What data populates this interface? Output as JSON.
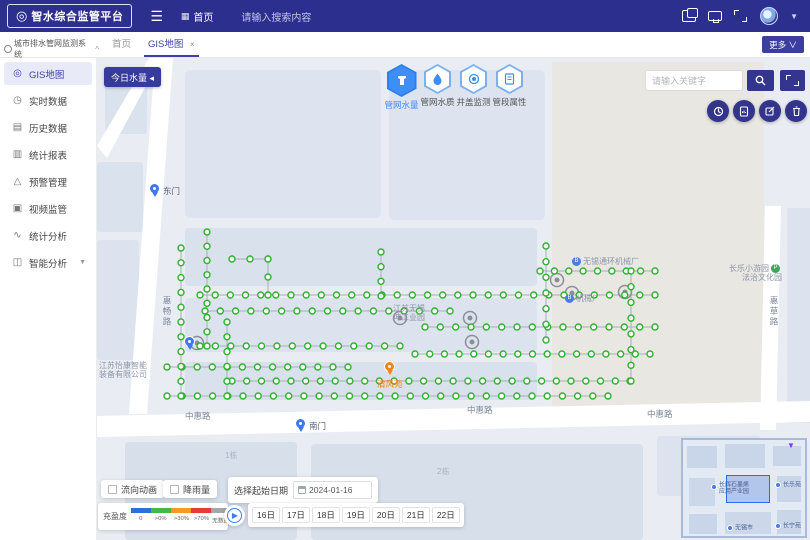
{
  "header": {
    "logo_text": "智水综合监管平台",
    "nav_home": "首页",
    "search_placeholder": "请输入搜索内容"
  },
  "tabbar": {
    "system_title": "城市排水管网监测系统",
    "tabs": [
      {
        "label": "首页"
      },
      {
        "label": "GIS地图",
        "close": "×"
      }
    ],
    "more_label": "更多 ∨"
  },
  "sidebar": {
    "items": [
      {
        "label": "GIS地图",
        "active": true
      },
      {
        "label": "实时数据"
      },
      {
        "label": "历史数据"
      },
      {
        "label": "统计报表"
      },
      {
        "label": "预警管理"
      },
      {
        "label": "视频监管"
      },
      {
        "label": "统计分析"
      },
      {
        "label": "智能分析",
        "expandable": true
      }
    ]
  },
  "map": {
    "today_button": "今日水量 ◂",
    "layer_buttons": [
      {
        "label": "管网水量",
        "active": true
      },
      {
        "label": "管网水质"
      },
      {
        "label": "井盖监测"
      },
      {
        "label": "管段属性"
      }
    ],
    "search_placeholder": "请输入关键字",
    "streets": {
      "left_road": "惠畅路",
      "bottom_road_1": "中惠路",
      "bottom_road_2": "中惠路",
      "bottom_road_3": "中惠路",
      "right_road": "惠草路",
      "bldg_1": "1栋",
      "bldg_2": "2栋"
    },
    "pois": {
      "gate_east": "东门",
      "gate_south": "南门",
      "spring": "清风苑",
      "factory_1": "无锡通环机械厂",
      "factory_2": "机械厂",
      "park_l1": "长乐小游园",
      "park_l2": "法治文化园",
      "industry_l1": "江苏无锡",
      "industry_l2": "坤工业园",
      "company_l1": "江苏怡康智能",
      "company_l2": "装备有限公司"
    },
    "network": {
      "spacing": 15,
      "node_color": "#2db32d",
      "line_color": "#a9aeb8",
      "segments": [
        [
          103,
          237,
          558,
          237
        ],
        [
          108,
          253,
          353,
          253
        ],
        [
          328,
          269,
          558,
          269
        ],
        [
          103,
          288,
          303,
          288
        ],
        [
          318,
          296,
          553,
          296
        ],
        [
          70,
          309,
          251,
          309
        ],
        [
          135,
          323,
          533,
          323
        ],
        [
          70,
          338,
          511,
          338
        ],
        [
          135,
          201,
          171,
          201
        ],
        [
          443,
          213,
          558,
          213
        ],
        [
          84,
          190,
          84,
          338
        ],
        [
          110,
          174,
          110,
          288
        ],
        [
          130,
          264,
          130,
          338
        ],
        [
          284,
          194,
          284,
          238
        ],
        [
          449,
          188,
          449,
          282
        ],
        [
          534,
          213,
          534,
          323
        ],
        [
          171,
          201,
          171,
          237
        ]
      ],
      "rings": [
        [
          100,
          285
        ],
        [
          373,
          260
        ],
        [
          375,
          284
        ],
        [
          460,
          222
        ],
        [
          528,
          234
        ],
        [
          303,
          260
        ],
        [
          475,
          235
        ]
      ]
    }
  },
  "controls": {
    "checkboxes": [
      {
        "label": "流向动画",
        "checked": false
      },
      {
        "label": "降雨量",
        "checked": false
      }
    ],
    "date_label": "选择起始日期",
    "date_value": "2024-01-16",
    "dates": [
      "16日",
      "17日",
      "18日",
      "19日",
      "20日",
      "21日",
      "22日"
    ],
    "legend": {
      "title": "充盈度",
      "items": [
        {
          "label": "0",
          "color": "#2e6fd8"
        },
        {
          "label": ">0%",
          "color": "#45b649"
        },
        {
          "label": ">30%",
          "color": "#f59a23"
        },
        {
          "label": ">70%",
          "color": "#e23c39"
        },
        {
          "label": "无数据",
          "color": "#a6a6a6"
        }
      ]
    }
  },
  "minimap": {
    "labels": [
      {
        "text": "长辉石墨烯",
        "text2": "应用产业园"
      },
      {
        "text": "长乐苑"
      },
      {
        "text": "无锡市"
      },
      {
        "text": "长宁苑"
      }
    ]
  },
  "colors": {
    "accent": "#2d2f8e",
    "layer_active": "#3e8ef7",
    "orange": "#f08519"
  }
}
